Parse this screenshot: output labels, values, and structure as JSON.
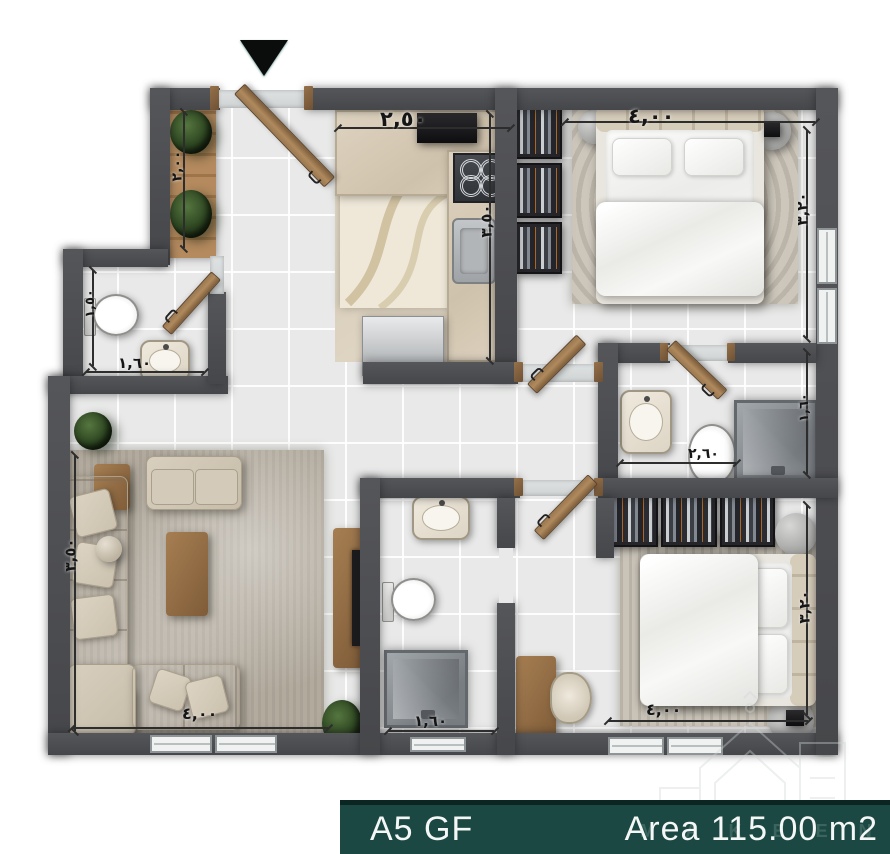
{
  "footer": {
    "left_label": "A5 GF",
    "right_label": "Area 115.00 m2",
    "watermark_text": "M A K E E N",
    "bar_color": "#1b4843",
    "text_color": "#f4f7f6"
  },
  "colors": {
    "wall": "#4b4c4e",
    "floor_tile": "#e8e9e8",
    "wood": "#a8815a",
    "kitchen_counter": "#d9cdba",
    "accent_teal": "#1b4843"
  },
  "entrance": {
    "icon": "down-triangle"
  },
  "dimensions": {
    "entry_width": "٢,٥٠",
    "kitchen_depth": "٣,٥٠",
    "balcony_length": "٢,٠٠",
    "bedroom1_width": "٤,٠٠",
    "bedroom1_depth": "٣,٢٠",
    "wc_width": "١,٦٠",
    "wc_depth": "١,٥٠",
    "living_depth": "٣,٥٠",
    "living_width": "٤,٠٠",
    "bath2_width": "١,٦٠",
    "ensuite_width": "٢,٦٠",
    "ensuite_depth": "١,٦٠",
    "bedroom2_width": "٤,٠٠",
    "bedroom2_depth": "٣,٢٠"
  }
}
